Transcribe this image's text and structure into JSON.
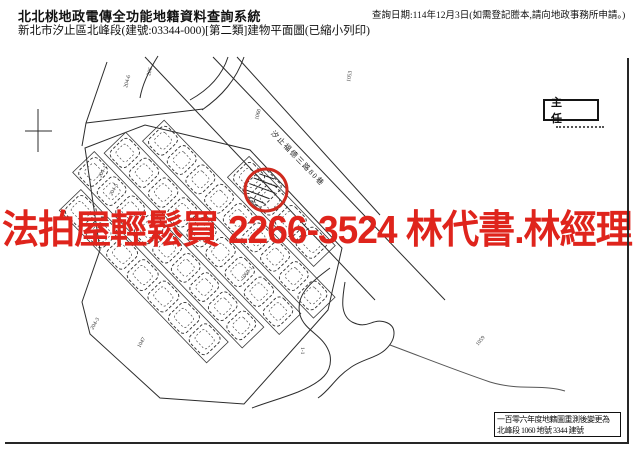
{
  "header": {
    "system_title": "北北桃地政電傳全功能地籍資料查詢系統",
    "document_title": "新北市汐止區北峰段(建號:03344-000)[第二類]建物平面圖(已縮小列印)",
    "query_date_note": "查詢日期:114年12月3日(如需登記謄本,請向地政事務所申請。)"
  },
  "watermark": {
    "text": "法拍屋輕鬆買  2266-3524  林代書.林經理",
    "phone": "2266-3524",
    "color": "#df241c"
  },
  "map": {
    "street_label": "汐止福德三路80巷",
    "subject_building": "3344",
    "stamp": {
      "title": "主 任"
    },
    "note_box": {
      "line1": "一百零六年度地籍圖重測後變更為",
      "line2": "北峰段 1060 地號 3344 建號"
    },
    "parcel_labels": [
      {
        "text": "204-6",
        "x": 127,
        "y": 88,
        "rot": -75
      },
      {
        "text": "206",
        "x": 150,
        "y": 76,
        "rot": -75
      },
      {
        "text": "1053",
        "x": 350,
        "y": 82,
        "rot": -80
      },
      {
        "text": "204-1",
        "x": 101,
        "y": 178,
        "rot": -62
      },
      {
        "text": "204-5",
        "x": 112,
        "y": 196,
        "rot": -62
      },
      {
        "text": "1060",
        "x": 258,
        "y": 120,
        "rot": -75
      },
      {
        "text": "1-1",
        "x": 301,
        "y": 347,
        "rot": 90
      },
      {
        "text": "1047",
        "x": 140,
        "y": 348,
        "rot": -60
      },
      {
        "text": "204-3",
        "x": 93,
        "y": 330,
        "rot": -60
      },
      {
        "text": "1060-1",
        "x": 243,
        "y": 280,
        "rot": -50
      },
      {
        "text": "1059",
        "x": 478,
        "y": 346,
        "rot": -50
      }
    ],
    "housing_rows": [
      {
        "x": 95,
        "y": -46,
        "w": 124,
        "h": 30,
        "units": 4
      },
      {
        "x": 10,
        "y": -10,
        "w": 246,
        "h": 30,
        "units": 9
      },
      {
        "x": -8,
        "y": 26,
        "w": 252,
        "h": 30,
        "units": 9
      },
      {
        "x": -16,
        "y": 62,
        "w": 244,
        "h": 30,
        "units": 9
      },
      {
        "x": 2,
        "y": 98,
        "w": 212,
        "h": 30,
        "units": 7
      }
    ]
  }
}
